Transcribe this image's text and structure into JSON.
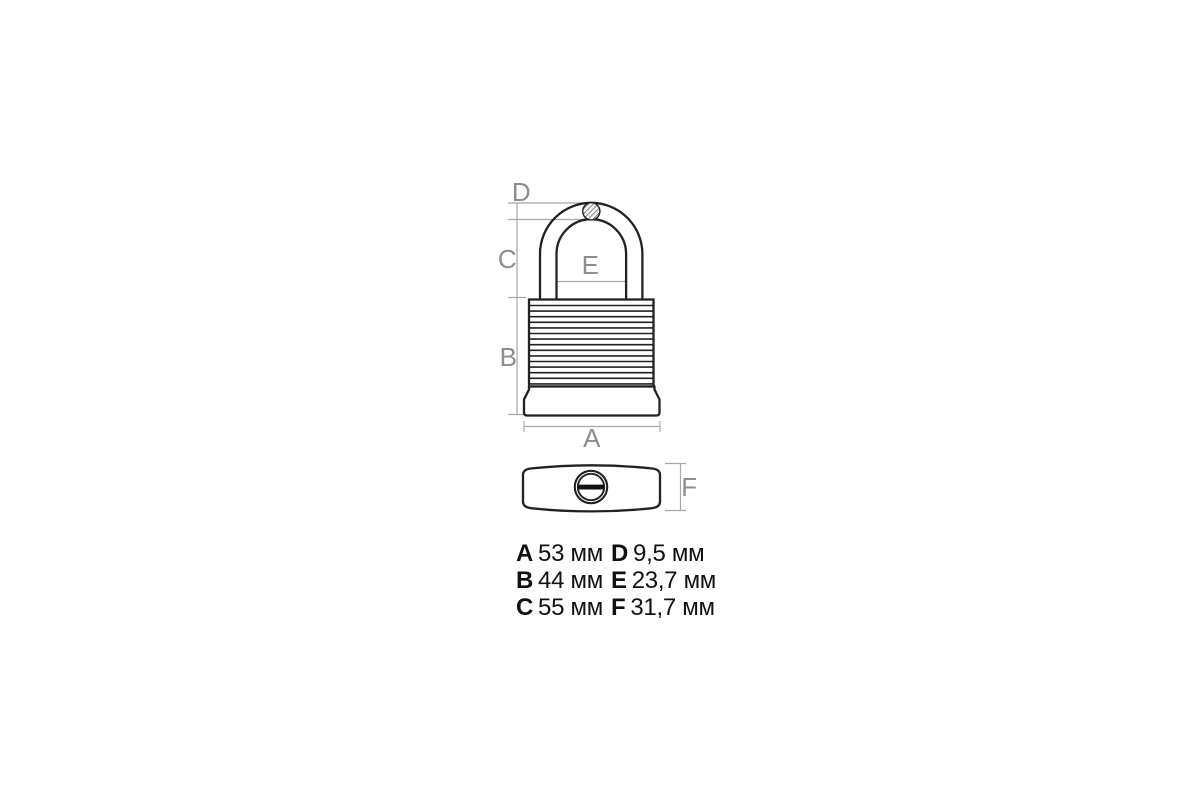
{
  "diagram": {
    "title": "padlock dimension drawing",
    "unit": "мм",
    "labels": {
      "A": "A",
      "B": "B",
      "C": "C",
      "D": "D",
      "E": "E",
      "F": "F"
    },
    "legend": {
      "items": [
        {
          "letter": "A",
          "value": "53 мм"
        },
        {
          "letter": "B",
          "value": "44 мм"
        },
        {
          "letter": "C",
          "value": "55 мм"
        },
        {
          "letter": "D",
          "value": "9,5 мм"
        },
        {
          "letter": "E",
          "value": "23,7 мм"
        },
        {
          "letter": "F",
          "value": "31,7 мм"
        }
      ]
    },
    "colors": {
      "background": "#ffffff",
      "outline": "#222222",
      "dimension_line": "#a8a8a8",
      "dimension_label": "#8e8e8e",
      "legend_text": "#111111",
      "key_slot": "#111111"
    }
  }
}
